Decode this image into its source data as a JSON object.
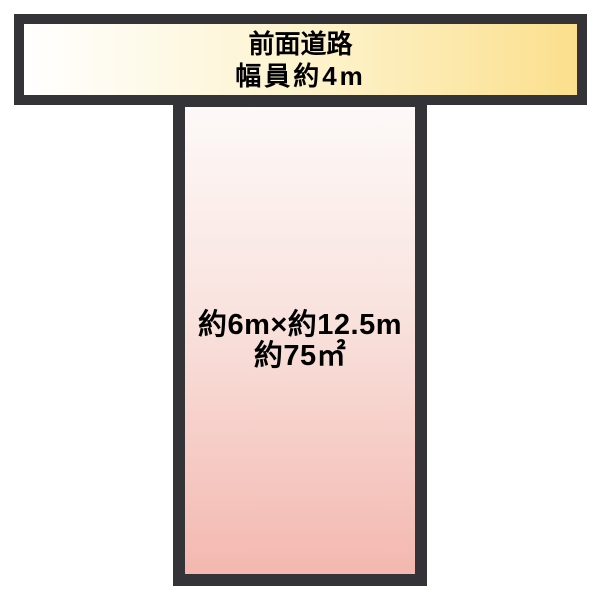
{
  "diagram": {
    "type": "land-plot-layout",
    "background_color": "#ffffff",
    "road": {
      "label_line1": "前面道路",
      "label_line2": "幅員約4m",
      "border_color": "#343338",
      "fill_gradient": [
        "#ffffff",
        "#fbdf8d"
      ],
      "text_color": "#000000"
    },
    "plot": {
      "size_label": "約6m×約12.5m",
      "area_label": "約75㎡",
      "border_color": "#343338",
      "fill_gradient": [
        "#fdf9f8",
        "#f3b8b0"
      ],
      "text_color": "#000000"
    }
  }
}
